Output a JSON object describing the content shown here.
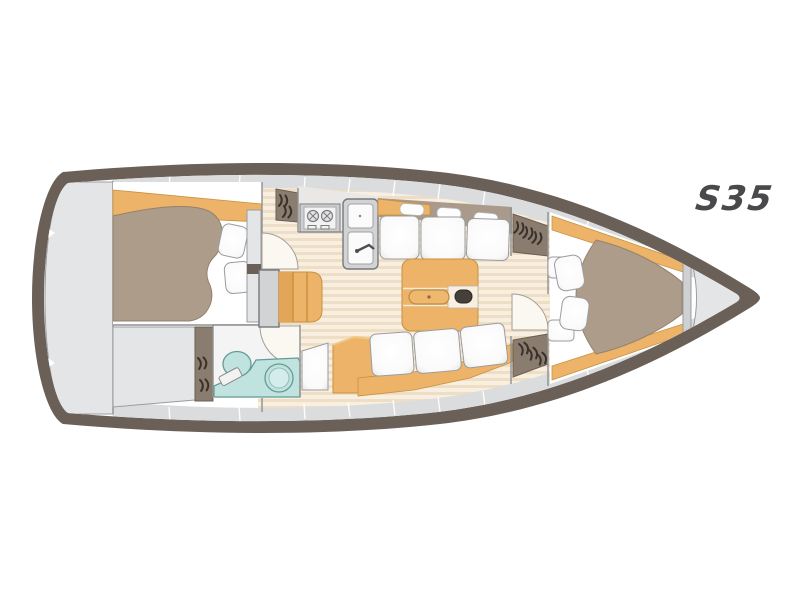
{
  "logo": {
    "text": "S35"
  },
  "diagram": {
    "type": "boat-floor-plan",
    "model_label": "S35",
    "areas": [
      "swim-platform",
      "aft-cabin-double-berth",
      "cockpit-locker",
      "head-with-toilet-and-round-sink",
      "companionway-steps",
      "galley-with-stove-and-double-sink",
      "salon-settees-and-folding-table",
      "nav-station-with-chart-table",
      "midship-hatched-lockers",
      "forward-v-berth-cabin",
      "anchor-locker"
    ]
  },
  "palette": {
    "hull": "#6a6057",
    "band_gray": "#dbdcde",
    "panel_gray": "#e4e5e7",
    "panel_gray_stroke": "#9c9da0",
    "floor_light": "#f8efe0",
    "floor_stripe": "#eedec5",
    "wood": "#ecb369",
    "wood_stroke": "#c8913f",
    "berth": "#ad9c89",
    "berth_stroke": "#93826f",
    "taupe_locker": "#8a7c6f",
    "taupe_stroke": "#6b5f53",
    "cushion_stroke": "#9b9c9e",
    "teal_fill": "#c0e3df",
    "teal_stroke": "#649c95",
    "dark_knob": "#453f39",
    "logo": "#49494b",
    "wall_line": "#8f9092"
  }
}
